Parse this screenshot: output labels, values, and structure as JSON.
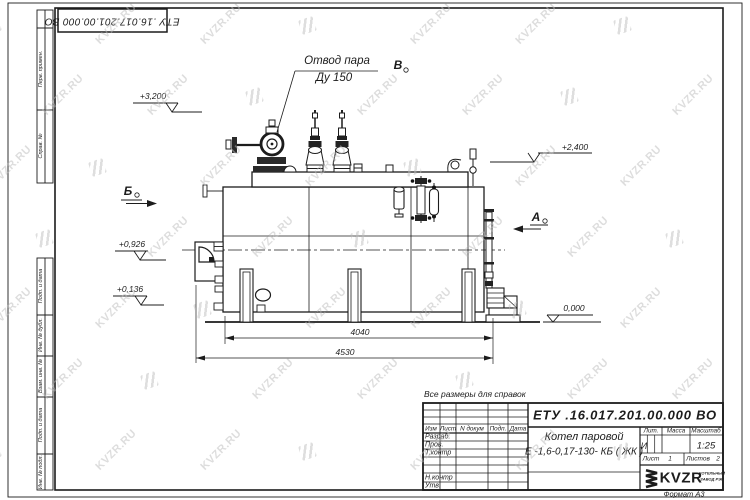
{
  "watermark": {
    "text": "KVZR.RU",
    "color": "#bcbcbc",
    "opacity": 0.5,
    "rows": 7,
    "cols": 7
  },
  "stamp_top": {
    "number": "ЕТУ .16.017.201.00.000  ВО"
  },
  "margin_labels": {
    "perv": "Перв. примен.",
    "sprav": "Справ. №",
    "podp1": "Подп. и дата",
    "inv_dubl": "Инв. № дубл.",
    "vzam": "Взам. инв. №",
    "podp2": "Подп. и дата",
    "inv_podl": "Инв. № подл."
  },
  "drawing": {
    "callout": {
      "line1": "Отвод пара",
      "line2": "Ду 150"
    },
    "views": {
      "b_top": "В",
      "b_left": "Б",
      "a_right": "А"
    },
    "elevations": {
      "e1": "+3,200",
      "e2": "+2,400",
      "e3": "+0,926",
      "e4": "+0,136",
      "e5": "0,000"
    },
    "dims": {
      "d1": "4040",
      "d2": "4530"
    }
  },
  "note": "Все размеры для справок",
  "title_block": {
    "doc_number": "ЕТУ .16.017.201.00.000  ВО",
    "name_line1": "Котел паровой",
    "name_line2": "Е -1,6-0,17-130- КБ ( ЖК )",
    "cols": {
      "izm": "Изм",
      "list": "Лист",
      "n_dokum": "N докум",
      "podp": "Подп.",
      "data": "Дата"
    },
    "rows": {
      "razrab": "Разраб.",
      "prov": "Пров.",
      "tkontr": "Т.контр",
      "nkontr": "Н.контр",
      "utv": "Утв."
    },
    "lit_header": "Лит.",
    "massa_header": "Масса",
    "masshtab_header": "Масштаб",
    "lit_value": "И",
    "scale_value": "1:25",
    "sheet_label": "Лист",
    "sheet_value": "1",
    "sheets_label": "Листов",
    "sheets_value": "2",
    "logo_text": "KVZR",
    "logo_sub1": "КОТЕЛЬНЫЙ",
    "logo_sub2": "ЗАВОД РЭП",
    "format": "Формат  А3"
  }
}
